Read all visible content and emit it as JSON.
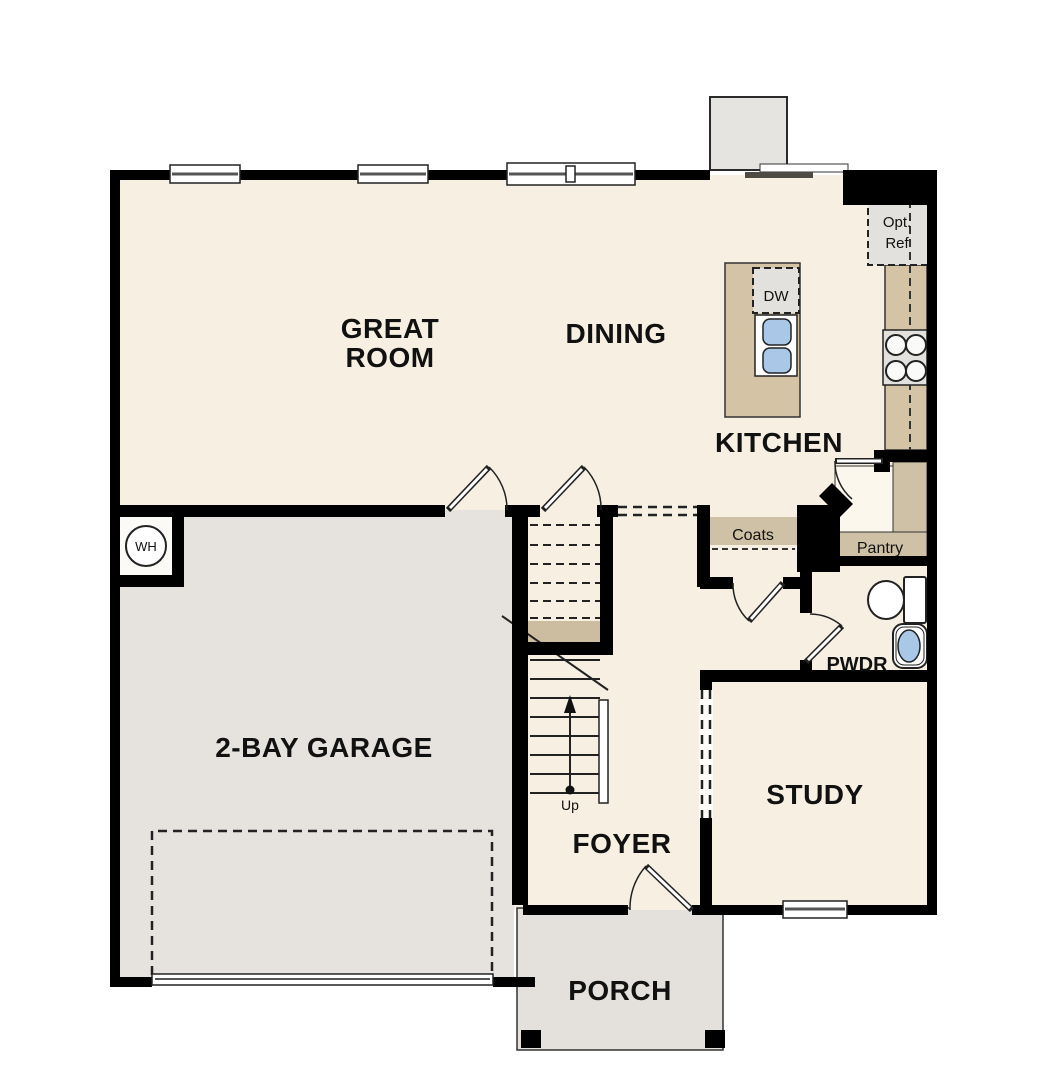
{
  "plan": {
    "rooms": {
      "great_room_line1": "GREAT",
      "great_room_line2": "ROOM",
      "dining": "DINING",
      "kitchen": "KITCHEN",
      "garage": "2-BAY GARAGE",
      "foyer": "FOYER",
      "study": "STUDY",
      "porch": "PORCH",
      "pwdr": "PWDR",
      "pantry": "Pantry",
      "coats": "Coats"
    },
    "fixtures": {
      "dishwasher": "DW",
      "opt_ref_line1": "Opt.",
      "opt_ref_line2": "Ref",
      "water_heater": "WH",
      "stairs_up": "Up"
    },
    "colors": {
      "wall": "#000000",
      "floor": "#f6efe2",
      "garage_floor": "#e6e3de",
      "porch_floor": "#e4e1dc",
      "counter": "#d4c3a5",
      "shelf": "#cfc1a6",
      "landing": "#ccbda0",
      "appliance": "#e2e1de",
      "fireplace": "#e6e4e1",
      "sink": "#a9c8e8",
      "niche": "#fbfaf7"
    }
  }
}
